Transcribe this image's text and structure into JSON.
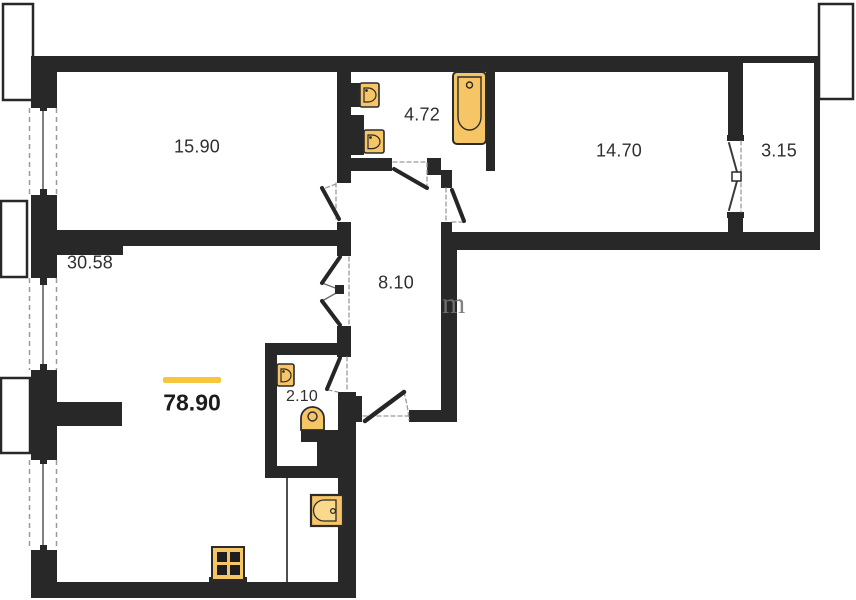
{
  "rooms": {
    "bedroom": {
      "area": "15.90"
    },
    "bathroom": {
      "area": "4.72"
    },
    "room": {
      "area": "14.70"
    },
    "balcony": {
      "area": "3.15"
    },
    "living": {
      "area": "30.58"
    },
    "hallway": {
      "area": "8.10"
    },
    "wc": {
      "area": "2.10"
    }
  },
  "total": {
    "area": "78.90"
  },
  "watermark": {
    "fragment": "m"
  },
  "colors": {
    "wall": "#282828",
    "fixture_fill": "#f5c566",
    "fixture_inner": "#fbd98c",
    "fixture_stroke": "#2b2b2b",
    "accent_bar": "#f7c63f",
    "label_text": "#2f2f2f",
    "dash": "#9a9a9a",
    "glass": "#555555"
  }
}
